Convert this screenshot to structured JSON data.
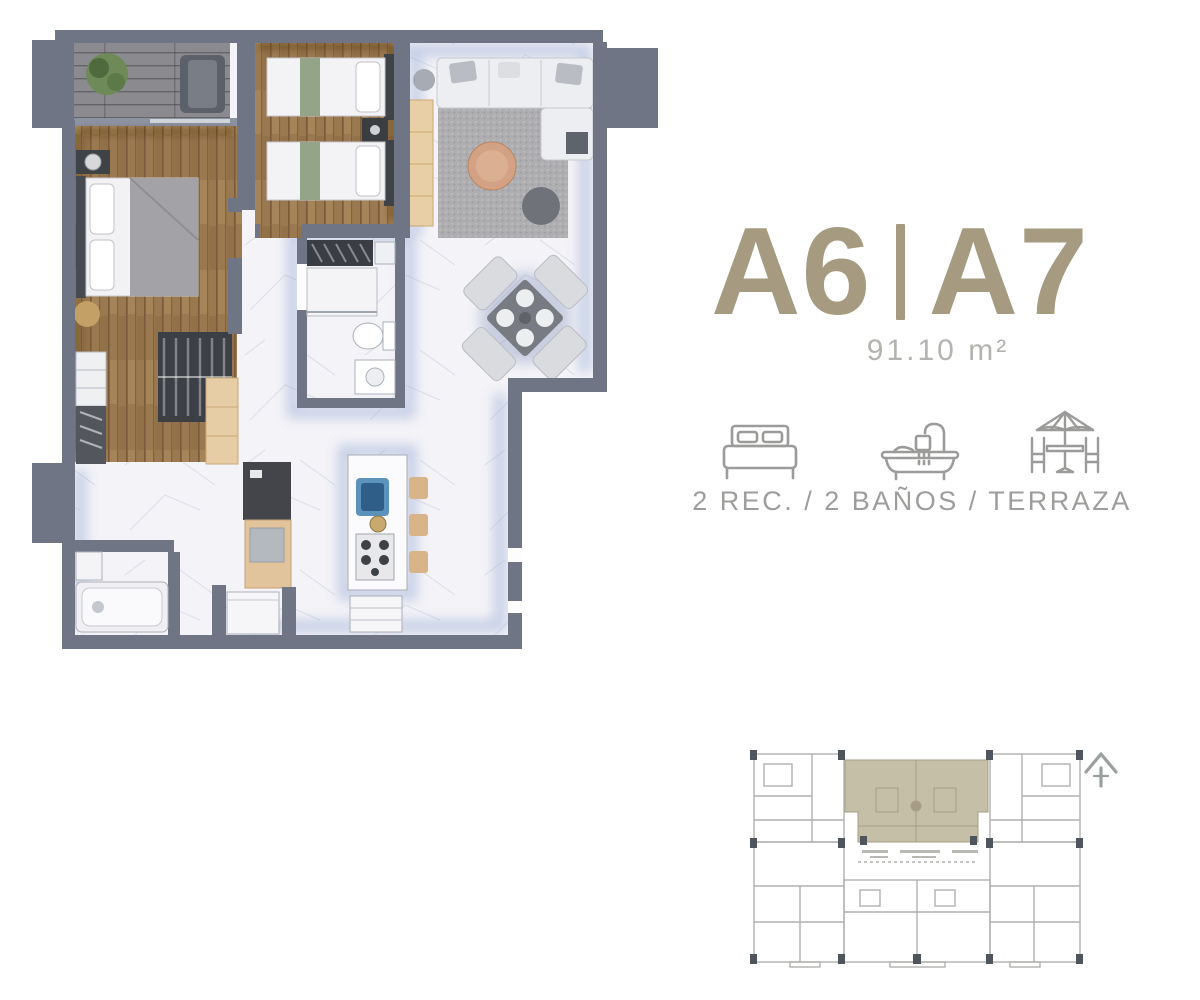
{
  "css_vars": {
    "--color-title": "#a69a80",
    "--color-area": "#b4b3af",
    "--color-caption": "#9d9d9b",
    "--color-icon": "#9b9b99",
    "--color-wall": "#6f7584",
    "--color-wood": "#9b7950",
    "--color-marble": "#f4f3f7",
    "--color-terrace-floor": "#8b8b8f",
    "--color-keyline": "#b0b1ad",
    "--color-key-highlight": "#c6bfa7",
    "--color-key-column": "#4e555c",
    "--color-sink-blue": "#5b93bd"
  },
  "unit": {
    "id_left": "A6",
    "id_right": "A7",
    "area": "91.10 m²",
    "features_caption": "2 REC. / 2 BAÑOS / TERRAZA",
    "feature_icons": [
      "bed-icon",
      "bathtub-icon",
      "terrace-icon"
    ]
  },
  "floor_plan": {
    "kind": "rendered top-view apartment plan",
    "zones": [
      "terrace-with-plant",
      "master-bedroom",
      "second-bedroom-twin-beds",
      "central-bathroom",
      "second-bathroom",
      "hall-closets",
      "kitchen-island-with-stools",
      "living-room-sofa-rug",
      "dining-table-4-chairs"
    ],
    "palette": {
      "walls": "#6f7584",
      "wood_floor": "#9b7950",
      "marble_floor": "#f4f3f7",
      "terrace_floor": "#8b8b8f",
      "rug": "#aeaeb1",
      "coffee_table": "#d3a183",
      "kitchen_sink": "#5b93bd",
      "tan_furniture": "#e6cda6"
    }
  },
  "key_plan": {
    "kind": "building level key plan",
    "highlighted_unit": "A6-A7 top center",
    "highlight_color": "#c6bfa7",
    "line_color": "#b0b1ad",
    "north_arrow": "chevron pointing up, top right"
  }
}
